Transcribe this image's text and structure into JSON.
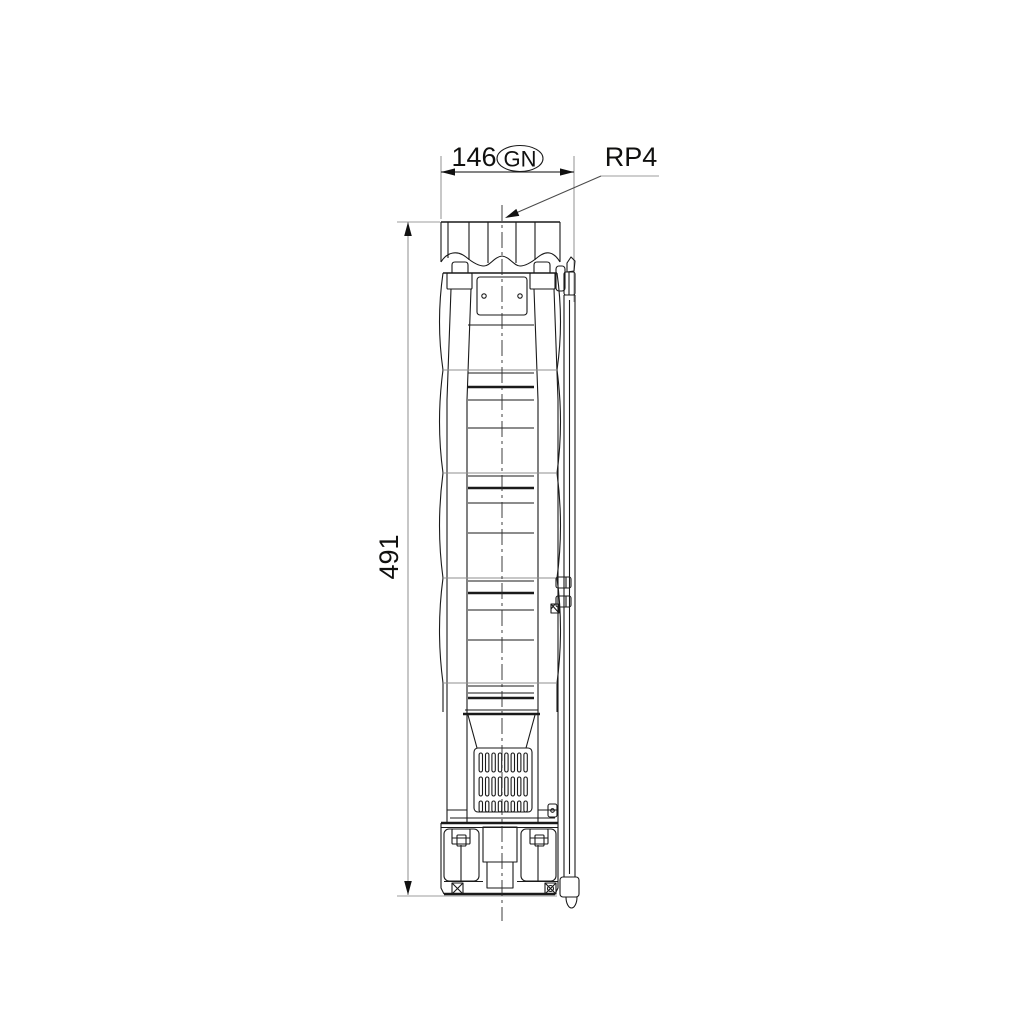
{
  "drawing": {
    "dimensions": {
      "width": {
        "value": "146",
        "port_code": "GN"
      },
      "height": {
        "value": "491"
      }
    },
    "labels": {
      "connection": "RP4"
    },
    "colors": {
      "outline": "#1a1a1a",
      "dimension_line": "#3a3a3a",
      "extension_line": "#9c9c9c",
      "text": "#10100f",
      "background": "#ffffff"
    }
  }
}
